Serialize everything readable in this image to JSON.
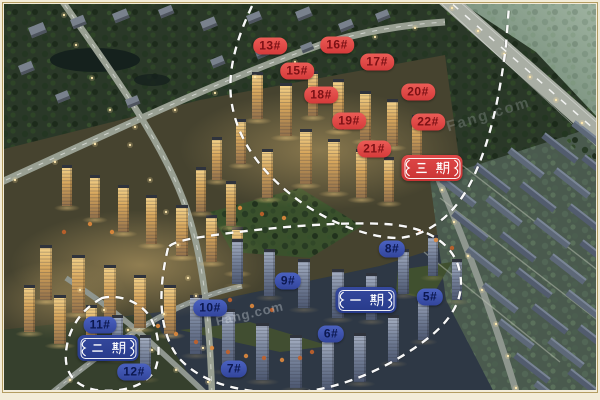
{
  "scene": {
    "type": "aerial-masterplan-rendering",
    "time": "dusk",
    "watermark": "Fang.com"
  },
  "phase_badges": [
    {
      "id": "phase-3",
      "label": "三期",
      "variant": "red",
      "x": 432,
      "y": 168
    },
    {
      "id": "phase-1",
      "label": "一期",
      "variant": "blue",
      "x": 366,
      "y": 300
    },
    {
      "id": "phase-2",
      "label": "二期",
      "variant": "blue",
      "x": 108,
      "y": 348
    }
  ],
  "building_labels": [
    {
      "label": "13#",
      "variant": "red",
      "x": 270,
      "y": 46
    },
    {
      "label": "16#",
      "variant": "red",
      "x": 337,
      "y": 45
    },
    {
      "label": "15#",
      "variant": "red",
      "x": 297,
      "y": 71
    },
    {
      "label": "17#",
      "variant": "red",
      "x": 377,
      "y": 62
    },
    {
      "label": "18#",
      "variant": "red",
      "x": 321,
      "y": 95
    },
    {
      "label": "20#",
      "variant": "red",
      "x": 418,
      "y": 92
    },
    {
      "label": "19#",
      "variant": "red",
      "x": 349,
      "y": 121
    },
    {
      "label": "22#",
      "variant": "red",
      "x": 428,
      "y": 122
    },
    {
      "label": "21#",
      "variant": "red",
      "x": 374,
      "y": 149
    },
    {
      "label": "8#",
      "variant": "blue",
      "x": 392,
      "y": 249
    },
    {
      "label": "9#",
      "variant": "blue",
      "x": 288,
      "y": 281
    },
    {
      "label": "5#",
      "variant": "blue",
      "x": 430,
      "y": 297
    },
    {
      "label": "10#",
      "variant": "blue",
      "x": 210,
      "y": 308
    },
    {
      "label": "6#",
      "variant": "blue",
      "x": 331,
      "y": 334
    },
    {
      "label": "7#",
      "variant": "blue",
      "x": 234,
      "y": 369
    },
    {
      "label": "11#",
      "variant": "blue",
      "x": 100,
      "y": 325
    },
    {
      "label": "12#",
      "variant": "blue",
      "x": 134,
      "y": 372
    }
  ],
  "colors": {
    "label_red_bg": "#d53a3a",
    "label_red_text": "#7c1115",
    "label_blue_bg": "#32459c",
    "label_blue_text": "#0c1850",
    "badge_red_bg": "#d84040",
    "badge_blue_bg": "#2f4197",
    "badge_text": "#ffffff",
    "boundary_dash": "#ffffff",
    "frame": "#f3ecd8",
    "frame_line": "#b49d62"
  }
}
